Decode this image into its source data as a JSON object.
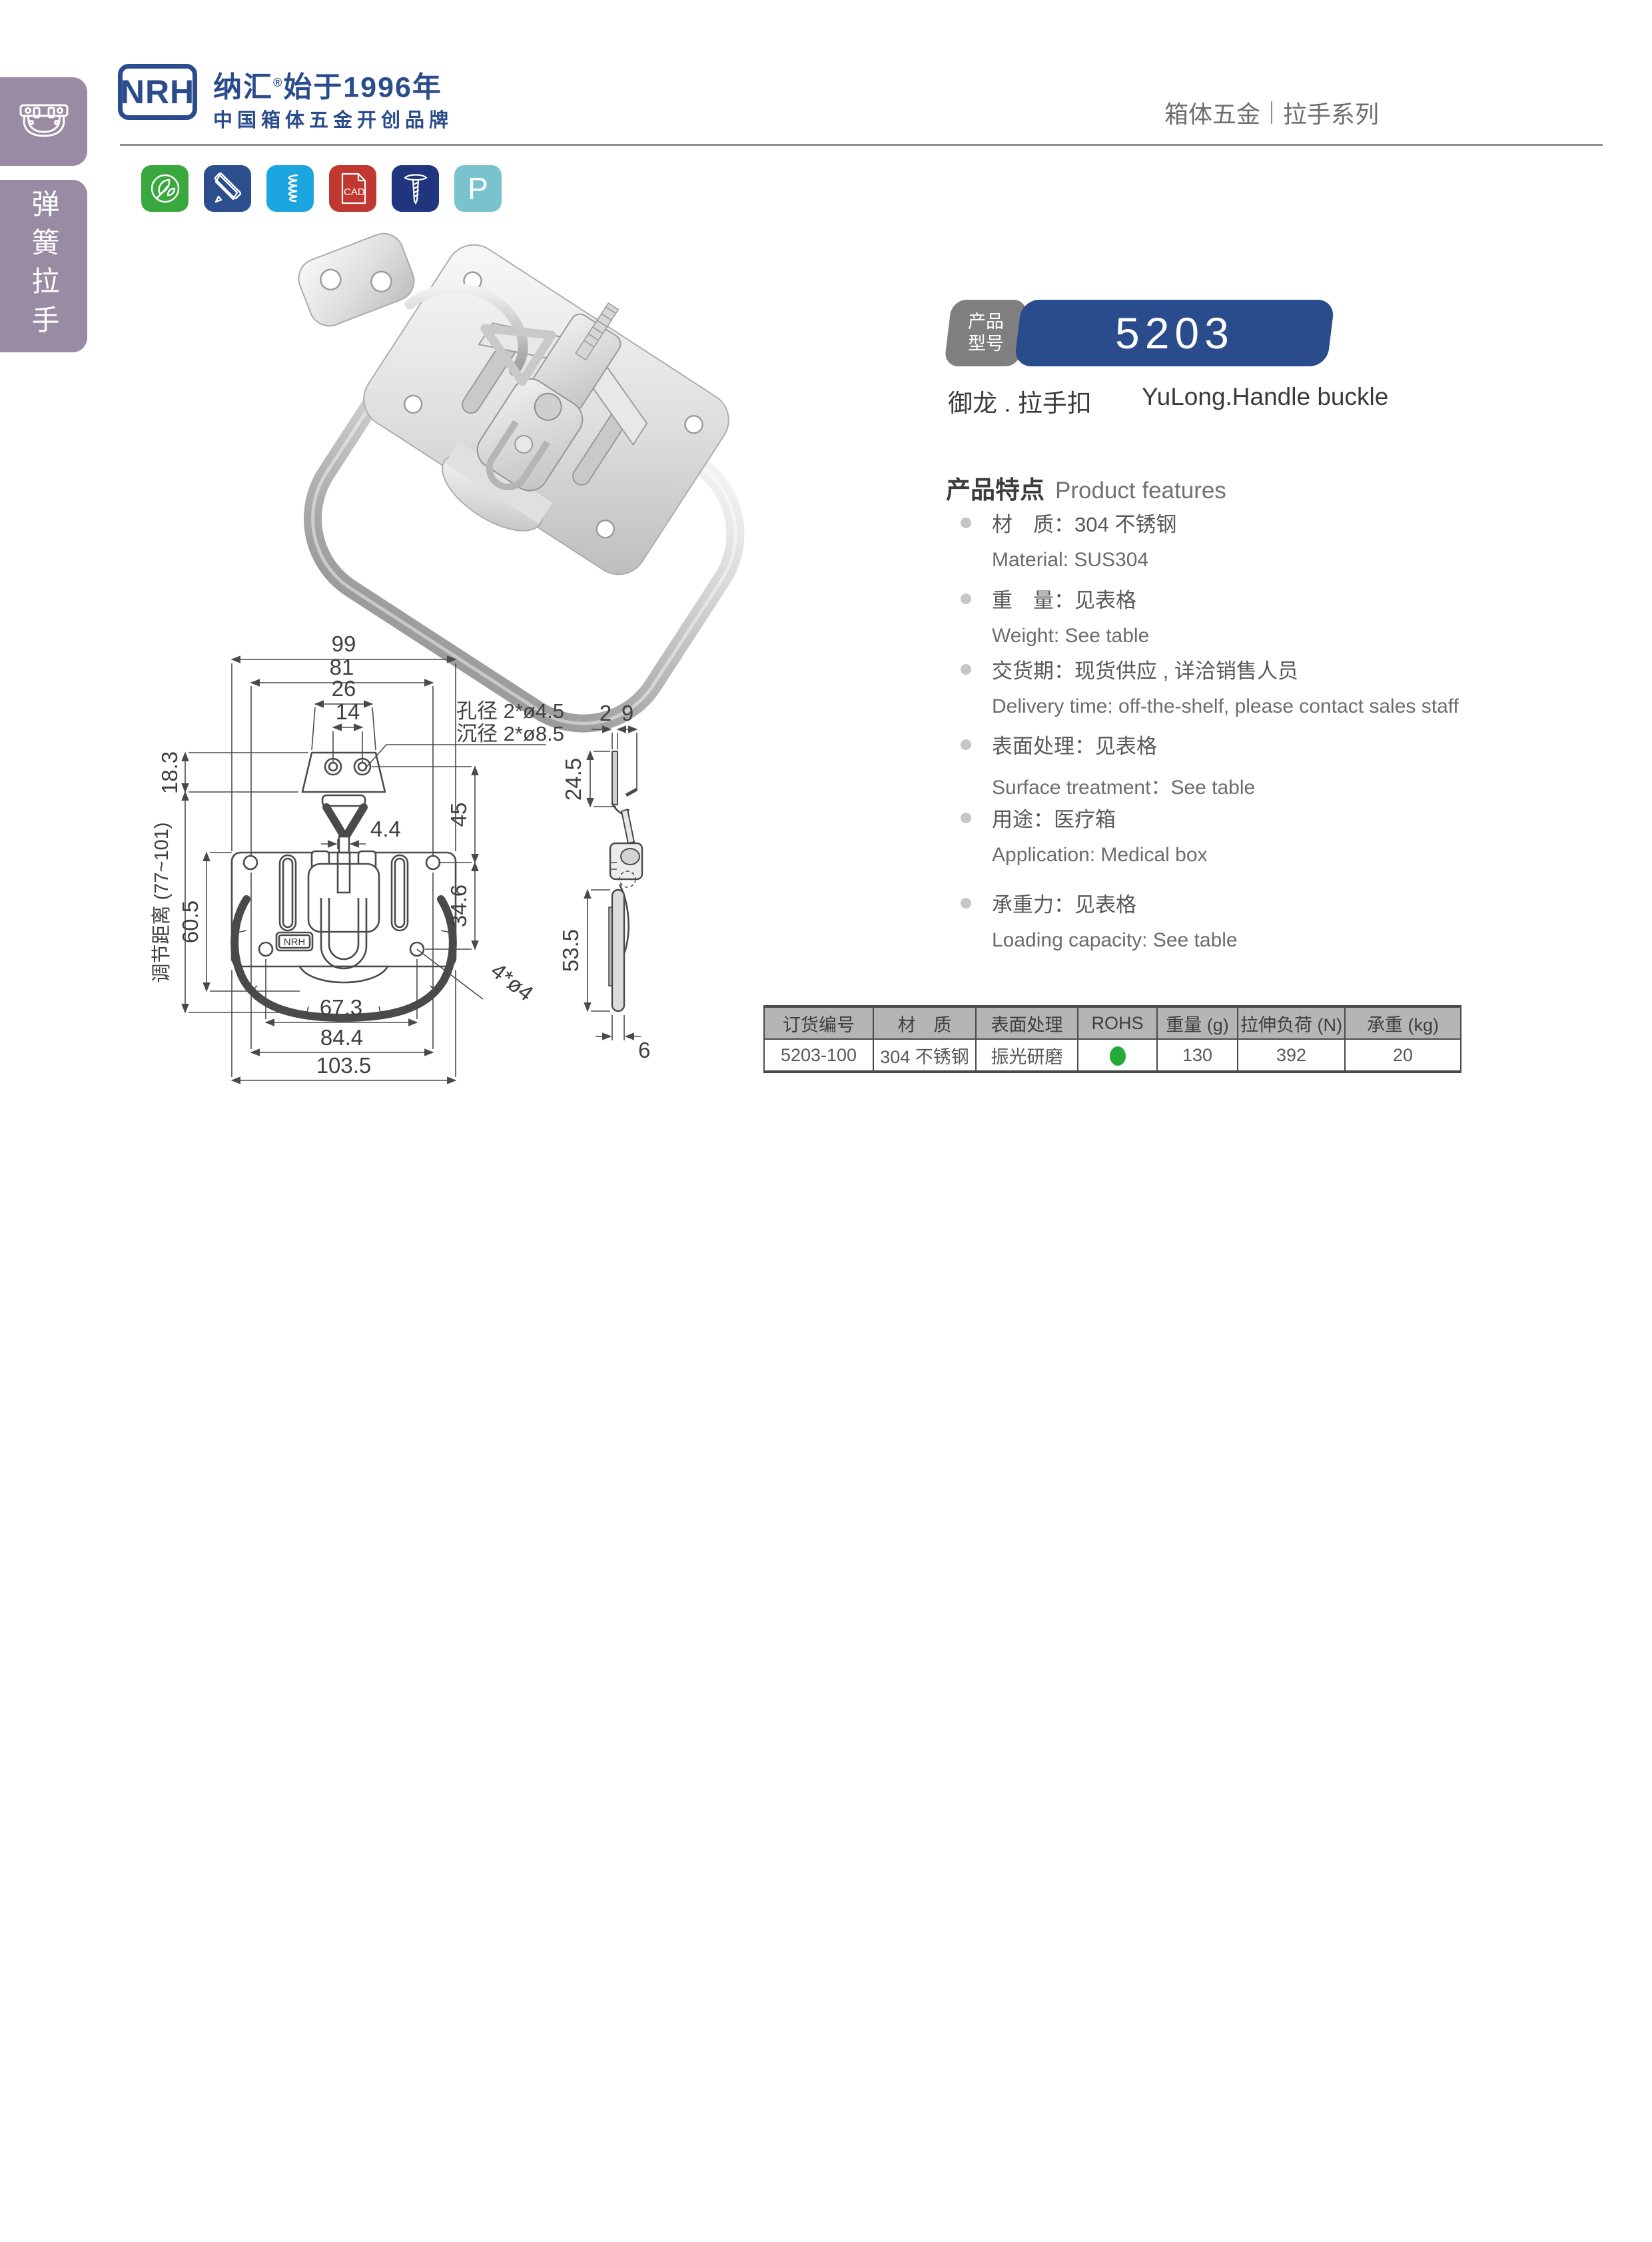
{
  "header": {
    "logo": "NRH",
    "brand_line1": "纳汇",
    "brand_reg": "®",
    "brand_line1b": "始于1996年",
    "brand_line2": "中国箱体五金开创品牌",
    "breadcrumb_left": "箱体五金",
    "breadcrumb_right": "拉手系列"
  },
  "sidebar": {
    "tab_label": "弹簧拉手"
  },
  "icons": {
    "cad_label": "CAD",
    "p_label": "P",
    "list": [
      {
        "name": "eco-leaf",
        "color": "#39a83e"
      },
      {
        "name": "design-tools",
        "color": "#2d4e8c"
      },
      {
        "name": "spring",
        "color": "#1ca6e0"
      },
      {
        "name": "cad-file",
        "color": "#c03830"
      },
      {
        "name": "screw",
        "color": "#20357e"
      },
      {
        "name": "letter-p",
        "color": "#79c3cf"
      }
    ]
  },
  "product": {
    "tag_line1": "产品",
    "tag_line2": "型号",
    "model": "5203",
    "name_zh": "御龙 . 拉手扣",
    "name_en": "YuLong.Handle buckle"
  },
  "features": {
    "title_zh": "产品特点",
    "title_en": "Product features",
    "items": [
      {
        "zh": "材　质：304 不锈钢",
        "en": "Material: SUS304"
      },
      {
        "zh": "重　量：见表格",
        "en": "Weight: See table"
      },
      {
        "zh": "交货期：现货供应 , 详洽销售人员",
        "en": "Delivery time: off-the-shelf, please contact sales staff"
      },
      {
        "zh": "表面处理：见表格",
        "en": "Surface treatment：See table"
      },
      {
        "zh": "用途：医疗箱",
        "en": "Application: Medical box"
      },
      {
        "zh": "承重力：见表格",
        "en": "Loading capacity: See table"
      }
    ]
  },
  "drawing": {
    "d99": "99",
    "d81": "81",
    "d26": "26",
    "d14": "14",
    "d18_3": "18.3",
    "adjust": "调节距离 (77~101)",
    "d60_5": "60.5",
    "d4_4": "4.4",
    "d45": "45",
    "d34_6": "34.6",
    "d67_3": "67.3",
    "d84_4": "84.4",
    "d103_5": "103.5",
    "note_hole": "孔径 2*ø4.5",
    "note_sink": "沉径 2*ø8.5",
    "note_4holes": "4*ø4",
    "d2": "2",
    "d9": "9",
    "d24_5": "24.5",
    "d53_5": "53.5",
    "d6": "6",
    "stamp": "NRH"
  },
  "table": {
    "headers": [
      "订货编号",
      "材　质",
      "表面处理",
      "ROHS",
      "重量 (g)",
      "拉伸负荷 (N)",
      "承重 (kg)"
    ],
    "row": {
      "code": "5203-100",
      "material": "304 不锈钢",
      "surface": "振光研磨",
      "weight": "130",
      "load": "392",
      "capacity": "20"
    },
    "rohs_green": "#22ab39"
  },
  "colors": {
    "brand_blue": "#2b4c8c",
    "sidebar_purple": "#9a8ba5",
    "table_header_gray": "#b5b5b5"
  }
}
